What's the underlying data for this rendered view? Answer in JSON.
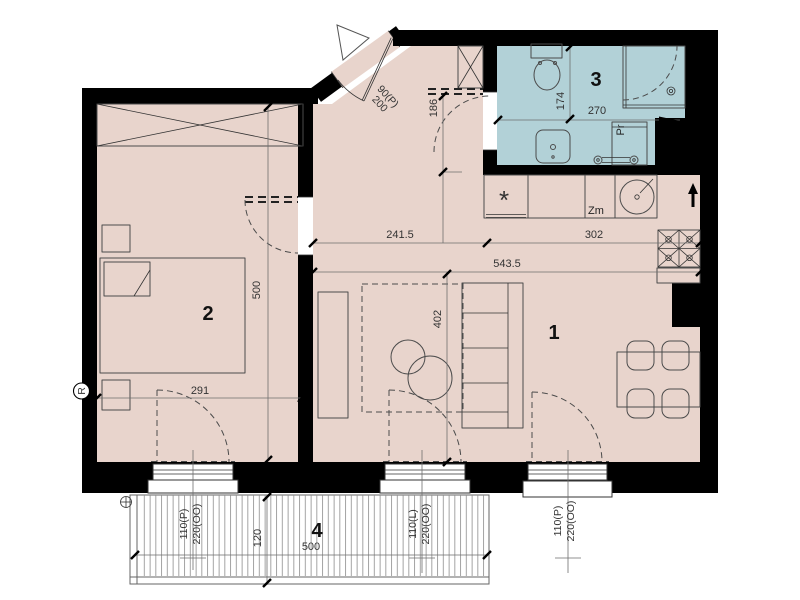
{
  "colors": {
    "wall": "#000000",
    "floor": "#e8d4cc",
    "bath_floor": "#b2d1d7",
    "line": "#4b4b4b",
    "dim_line": "#6e6e6e",
    "dim_text": "#333333",
    "hatch": "#8c8c8c"
  },
  "rooms": {
    "living": "1",
    "bedroom": "2",
    "bathroom": "3",
    "balcony": "4"
  },
  "dims": {
    "hall_width": "241.5",
    "kitchen_width": "302",
    "living_width": "543.5",
    "bedroom_height": "500",
    "bedroom_width": "291",
    "living_height": "402",
    "hall_depth": "186",
    "bath_height": "174",
    "bath_width": "270",
    "balcony_depth": "120",
    "balcony_width": "500",
    "door_main_w": "90(P)",
    "door_main_h": "200",
    "win_bedroom_w": "110(P)",
    "win_bedroom_h": "220(OO)",
    "win_living_left_w": "110(L)",
    "win_living_left_h": "220(OO)",
    "win_living_right_w": "110(P)",
    "win_living_right_h": "220(OO)"
  },
  "appliances": {
    "washer": "Pr",
    "dishwasher": "Zm",
    "fridge": "*",
    "thermostat": "R"
  }
}
